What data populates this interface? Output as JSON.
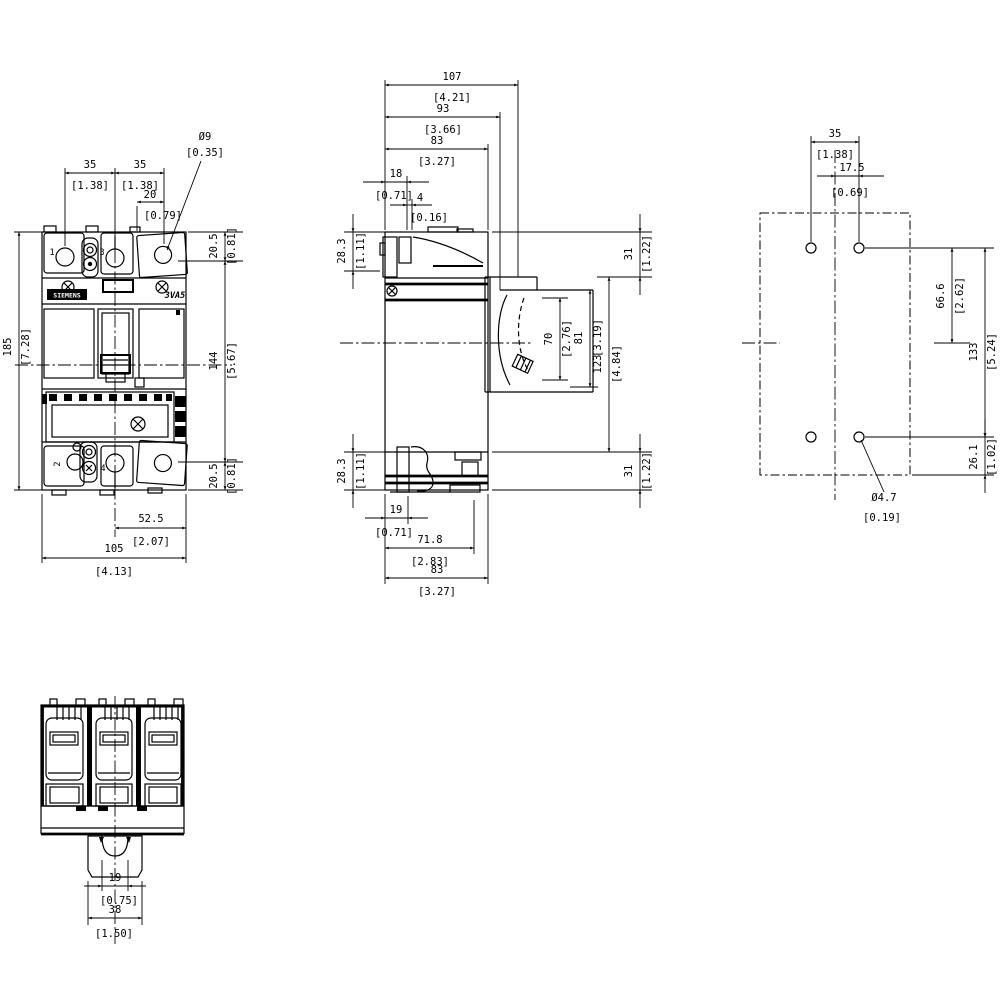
{
  "front": {
    "brand": "SIEMENS",
    "model": "3VA5",
    "t1": "1",
    "t2": "2",
    "t3": "3",
    "t4": "4",
    "dims": {
      "dia": {
        "mm": "Ø9",
        "in": "[0.35]"
      },
      "pitch_l": {
        "mm": "35",
        "in": "[1.38]"
      },
      "pitch_r": {
        "mm": "35",
        "in": "[1.38]"
      },
      "t20": {
        "mm": "20",
        "in": "[0.79]"
      },
      "term_top": {
        "mm": "20.5",
        "in": "[0.81]"
      },
      "height": {
        "mm": "185",
        "in": "[7.28]"
      },
      "mid": {
        "mm": "144",
        "in": "[5.67]"
      },
      "term_bot": {
        "mm": "20.5",
        "in": "[0.81]"
      },
      "half_w": {
        "mm": "52.5",
        "in": "[2.07]"
      },
      "width": {
        "mm": "105",
        "in": "[4.13]"
      }
    }
  },
  "side": {
    "dims": {
      "d107": {
        "mm": "107",
        "in": "[4.21]"
      },
      "d93": {
        "mm": "93",
        "in": "[3.66]"
      },
      "d83t": {
        "mm": "83",
        "in": "[3.27]"
      },
      "d18": {
        "mm": "18",
        "in": "[0.71]"
      },
      "d4": {
        "mm": "4",
        "in": "[0.16]"
      },
      "h283t": {
        "mm": "28.3",
        "in": "[1.11]"
      },
      "h31t": {
        "mm": "31",
        "in": "[1.22]"
      },
      "h70": {
        "mm": "70",
        "in": "[2.76]"
      },
      "h81": {
        "mm": "81",
        "in": "[3.19]"
      },
      "h123": {
        "mm": "123",
        "in": "[4.84]"
      },
      "h31b": {
        "mm": "31",
        "in": "[1.22]"
      },
      "h283b": {
        "mm": "28.3",
        "in": "[1.11]"
      },
      "d19": {
        "mm": "19",
        "in": "[0.71]"
      },
      "d718": {
        "mm": "71.8",
        "in": "[2.83]"
      },
      "d83b": {
        "mm": "83",
        "in": "[3.27]"
      }
    }
  },
  "mounting": {
    "dims": {
      "p35": {
        "mm": "35",
        "in": "[1.38]"
      },
      "p175": {
        "mm": "17.5",
        "in": "[0.69]"
      },
      "p666": {
        "mm": "66.6",
        "in": "[2.62]"
      },
      "p133": {
        "mm": "133",
        "in": "[5.24]"
      },
      "p261": {
        "mm": "26.1",
        "in": "[1.02]"
      },
      "dia": {
        "mm": "Ø4.7",
        "in": "[0.19]"
      }
    }
  },
  "bottom": {
    "dims": {
      "r19": {
        "mm": "19",
        "in": "[0.75]"
      },
      "r38": {
        "mm": "38",
        "in": "[1.50]"
      }
    }
  }
}
